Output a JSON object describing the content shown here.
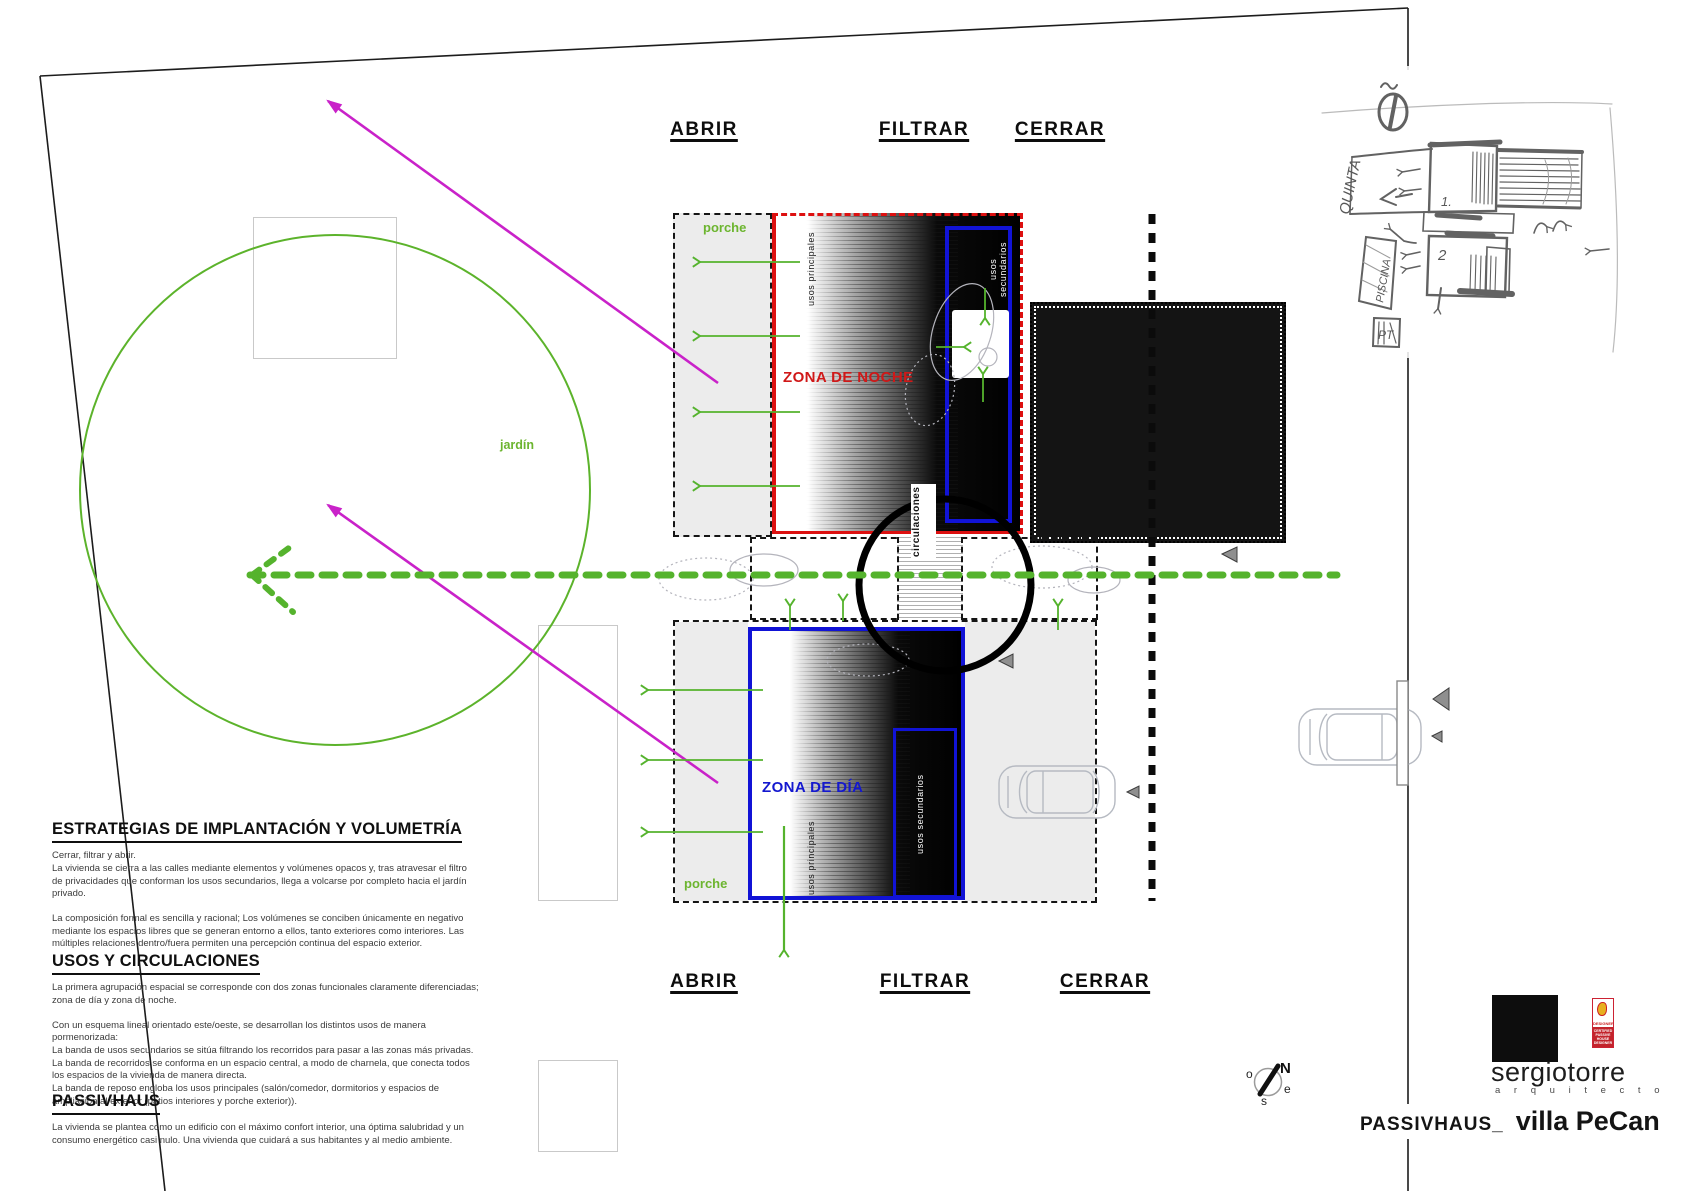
{
  "colors": {
    "green": "#55b32d",
    "magenta": "#c922c9",
    "red": "#dd1010",
    "blue": "#1113d6",
    "porche_gray": "#ececec",
    "black": "#0d0d0d"
  },
  "strategy": {
    "top": [
      "ABRIR",
      "FILTRAR",
      "CERRAR"
    ],
    "bottom": [
      "ABRIR",
      "FILTRAR",
      "CERRAR"
    ]
  },
  "plan": {
    "porche_top": "porche",
    "porche_bottom": "porche",
    "zona_noche": "ZONA DE NOCHE",
    "zona_dia": "ZONA DE DÍA",
    "usos_principales": "usos principales",
    "usos_secundarios": "usos secundarios",
    "circulaciones": "circulaciones",
    "jardin": "jardín"
  },
  "text_blocks": [
    {
      "heading": "ESTRATEGIAS DE IMPLANTACIÓN Y VOLUMETRÍA",
      "paragraphs": [
        "Cerrar, filtrar y abrir.",
        "La vivienda se cierra a las calles mediante elementos y volúmenes opacos y, tras atravesar el filtro de privacidades que conforman los usos secundarios, llega a volcarse por completo hacia el jardín privado.",
        "La composición formal es sencilla y racional; Los volúmenes se conciben únicamente en negativo mediante los espacios libres que se generan entorno a ellos, tanto exteriores como interiores. Las múltiples relaciones dentro/fuera permiten una percepción continua del espacio exterior."
      ]
    },
    {
      "heading": "USOS Y CIRCULACIONES",
      "paragraphs": [
        "La primera agrupación espacial se corresponde con dos zonas funcionales claramente diferenciadas;  zona de día y zona de noche.",
        "Con un esquema lineal orientado este/oeste, se desarrollan los distintos usos de manera pormenorizada:",
        "La banda de usos secundarios se sitúa filtrando los recorridos para pasar a las zonas más privadas.",
        "La banda de recorridos se conforma en un espacio central, a modo de charnela, que conecta todos los espacios de la vivienda de manera directa.",
        "La banda de reposo engloba los usos principales (salón/comedor, dormitorios y espacios de ampliación al exterior (patios interiores y porche exterior))."
      ]
    },
    {
      "heading": "PASSIVHAUS",
      "paragraphs": [
        "La vivienda se plantea como un edificio con el máximo confort interior, una óptima salubridad y un consumo energético casi nulo. Una vivienda que cuidará a sus habitantes y al medio ambiente."
      ]
    }
  ],
  "sketch": {
    "quinta": "QUINTA",
    "piscina": "PISCINA",
    "pt": "PT",
    "n1": "1.",
    "n2": "2"
  },
  "compass": {
    "n": "N",
    "o": "o",
    "e": "e",
    "s": "s"
  },
  "footer": {
    "studio": "sergiotorre",
    "studio_sub": "a r q u i t e c t o",
    "project_prefix": "PASSIVHAUS_",
    "project_name": "villa PeCan",
    "badge_top": "DESIGNER",
    "badge_bottom": "CERTIFIED PASSIVE HOUSE DESIGNER"
  }
}
